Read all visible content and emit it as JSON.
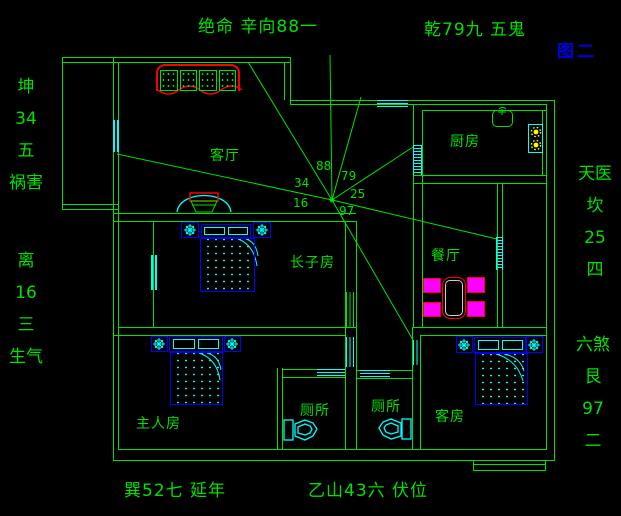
{
  "figure": {
    "caption": "图二"
  },
  "annotations": {
    "top": "绝命 辛向88一",
    "top_right": "乾79九 五鬼",
    "bottom_left": "巽52七 延年",
    "bottom_center": "乙山43六 伏位"
  },
  "side_labels": {
    "left_top": [
      "坤",
      "34",
      "五",
      "祸害"
    ],
    "left_bottom": [
      "离",
      "16",
      "三",
      "生气"
    ],
    "right_top": [
      "天医",
      "坎",
      "25",
      "四"
    ],
    "right_bottom": [
      "六煞",
      "艮",
      "97",
      "二"
    ]
  },
  "rooms": {
    "living": "客厅",
    "kitchen": "厨房",
    "dining": "餐厅",
    "eldest_son": "长子房",
    "master": "主人房",
    "toilet_left": "厕所",
    "toilet_right": "厕所",
    "guest": "客房"
  },
  "compass_numbers": {
    "n88": "88",
    "n79": "79",
    "n34": "34",
    "n25": "25",
    "n16": "16",
    "n97": "97"
  },
  "colors": {
    "background": "#000000",
    "wall_green": "#00e100",
    "window_cyan": "#00ffff",
    "furniture_blue": "#0000ff",
    "accent_red": "#ff0000",
    "chair_magenta": "#ff00ff",
    "burner_yellow": "#ffff00",
    "figure_blue": "#0000dd"
  }
}
